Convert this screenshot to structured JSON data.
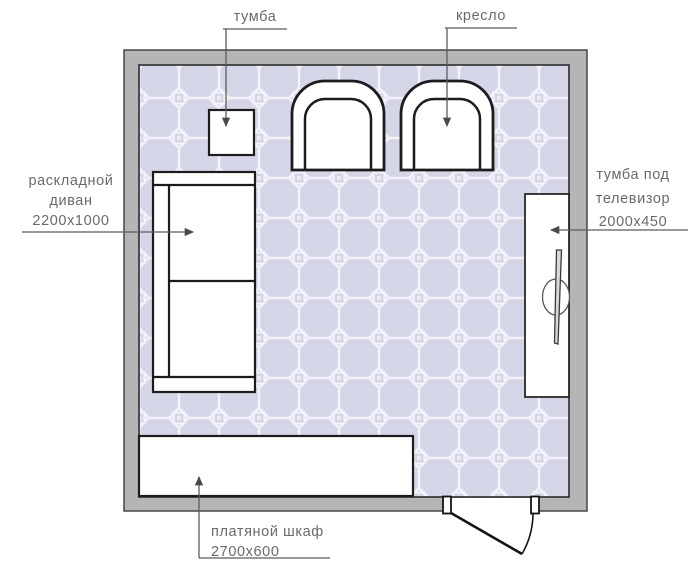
{
  "labels": {
    "cabinet": {
      "text": "тумба"
    },
    "armchair": {
      "text": "кресло"
    },
    "sofa": {
      "line1": "раскладной",
      "line2": "диван",
      "size": "2200x1000"
    },
    "tv_stand": {
      "line1": "тумба под",
      "line2": "телевизор",
      "size": "2000x450"
    },
    "wardrobe": {
      "name": "платяной шкаф",
      "size": "2700x600"
    }
  },
  "colors": {
    "wall_fill": "#b5b5b5",
    "wall_outline": "#3d3d3d",
    "floor_fill": "#d5d5e8",
    "floor_grout": "#f2f2f8",
    "furniture_fill": "#ffffff",
    "furniture_outline": "#1c1c1c",
    "leader_line": "#5c5c5c",
    "label_text": "#6a6a6a"
  }
}
